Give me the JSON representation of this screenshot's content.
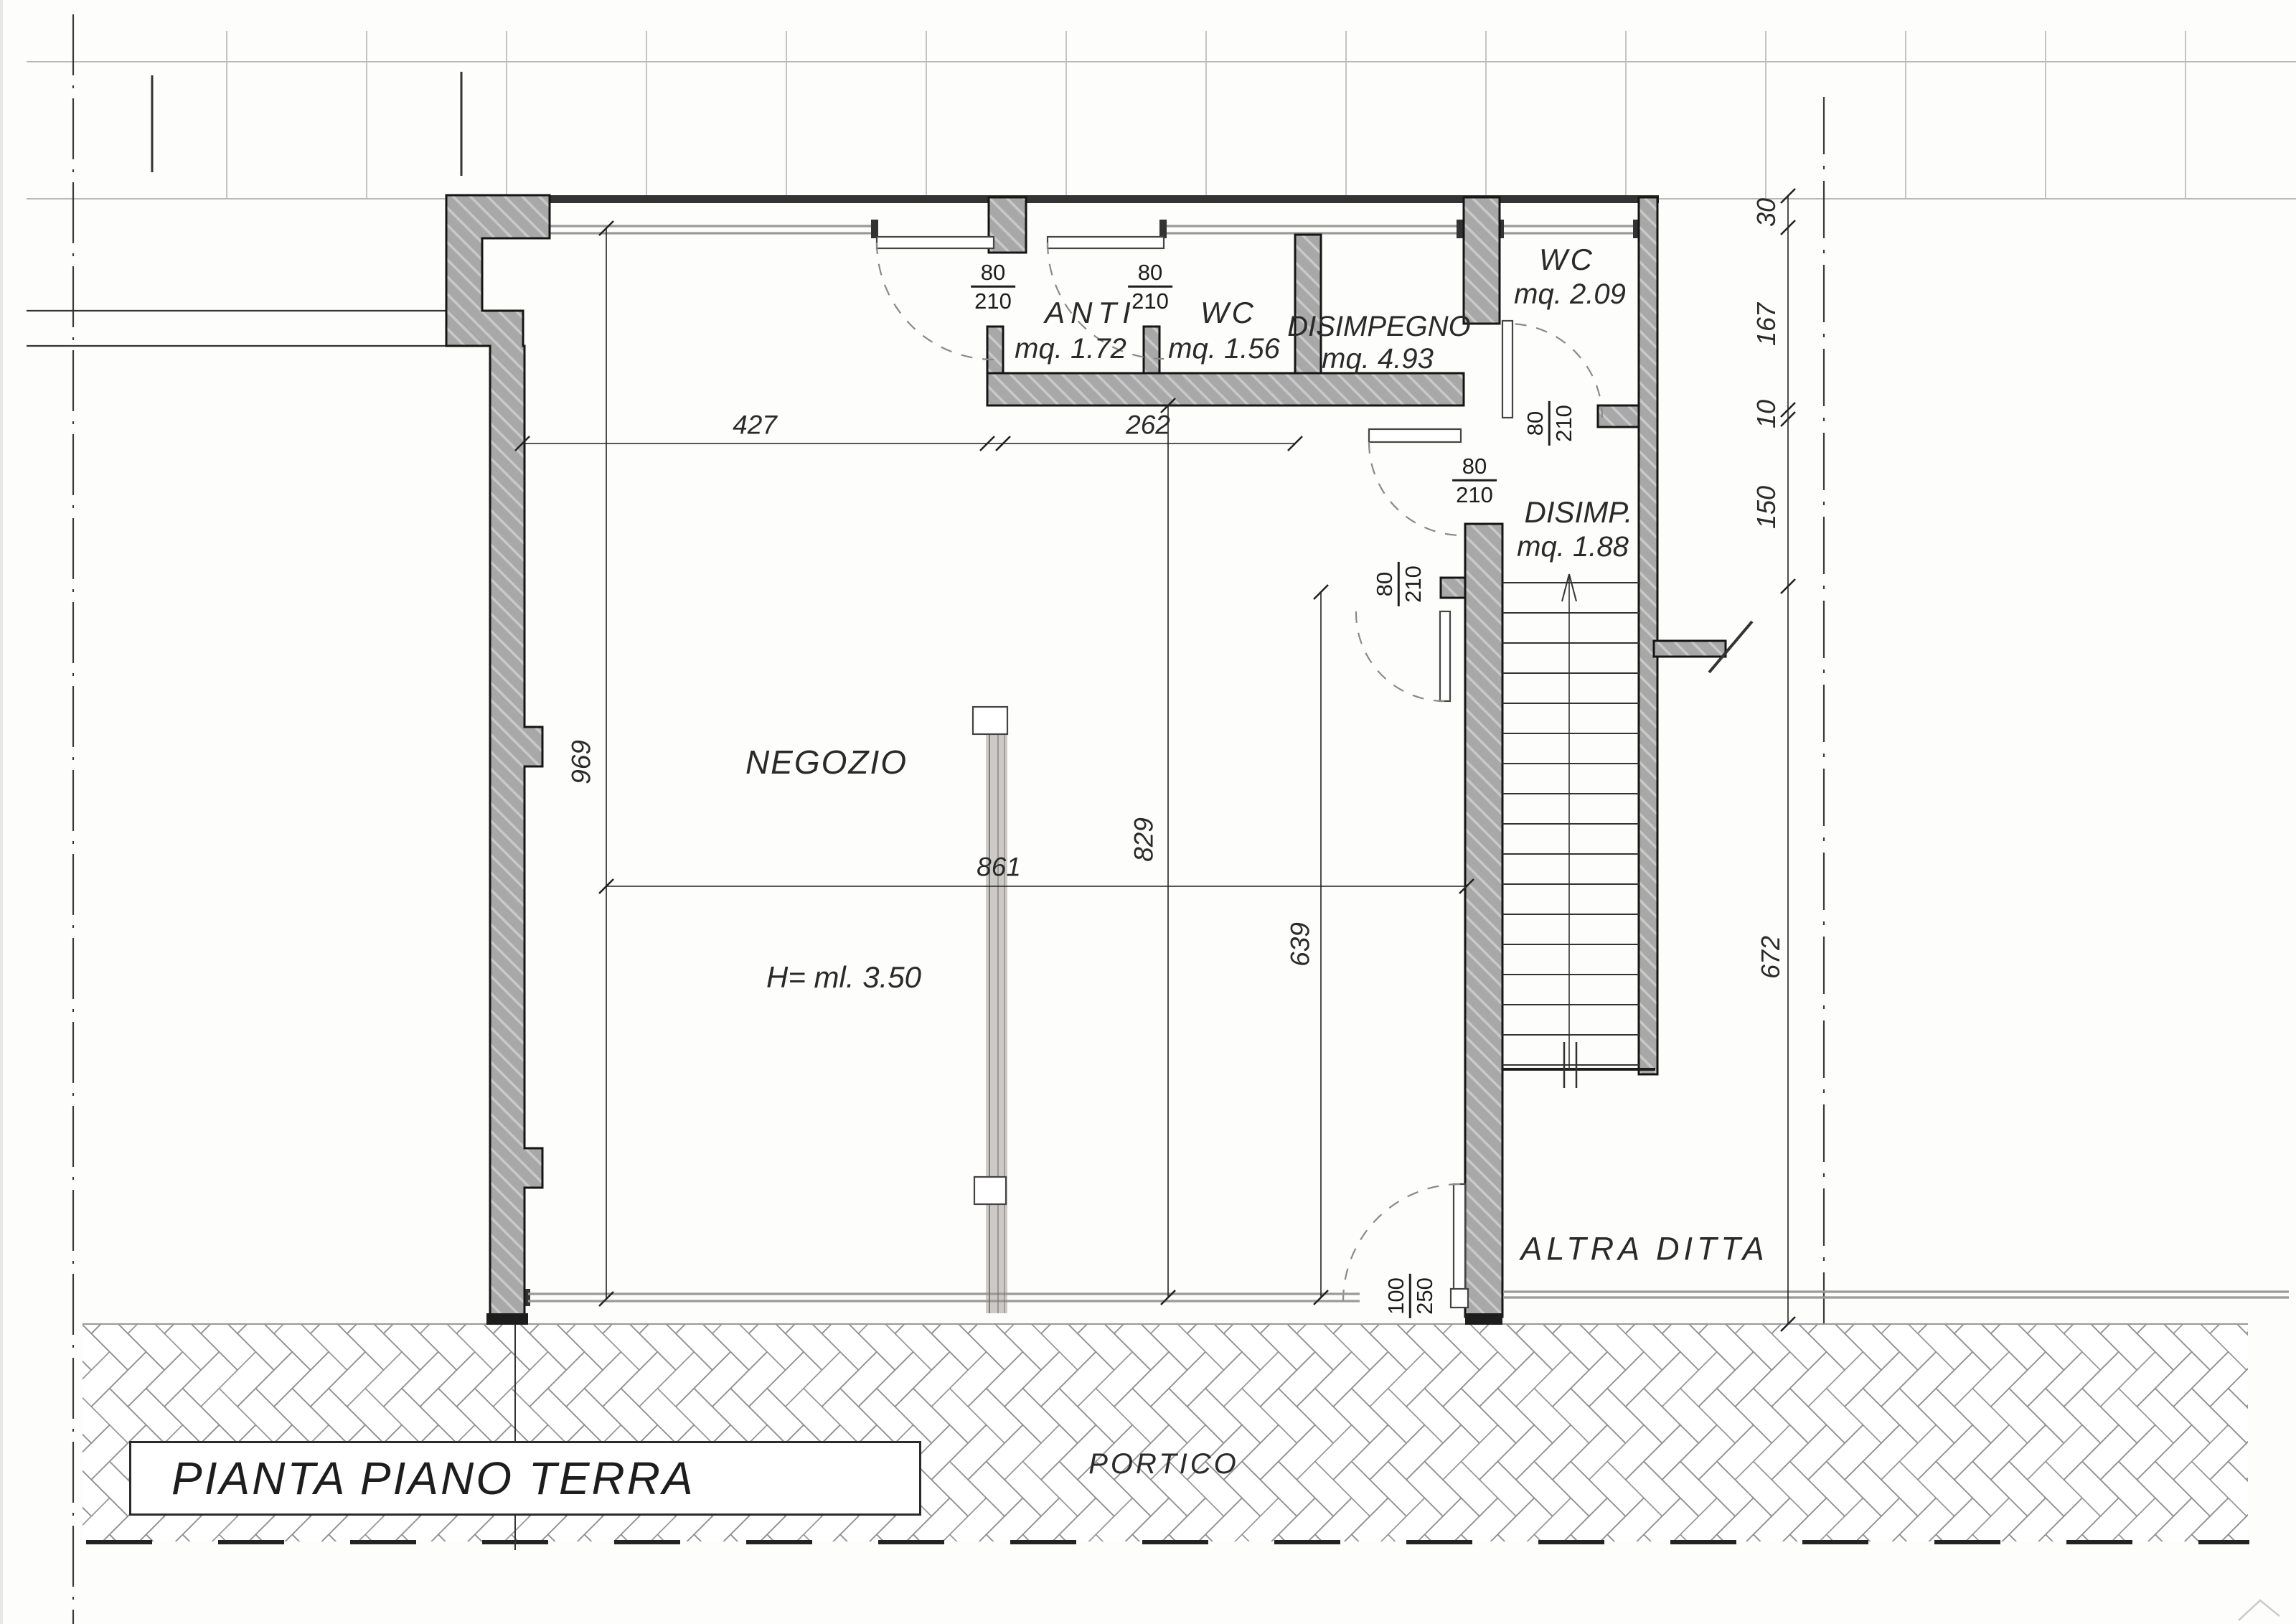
{
  "drawing": {
    "title": "PIANTA PIANO TERRA",
    "rooms": {
      "anti": {
        "name": "ANTI",
        "area": "mq. 1.72"
      },
      "wc_small": {
        "name": "WC",
        "area": "mq. 1.56"
      },
      "disimpegno": {
        "name": "DISIMPEGNO",
        "area": "mq. 4.93"
      },
      "wc_upper": {
        "name": "WC",
        "area": "mq. 2.09"
      },
      "disimp": {
        "name": "DISIMP.",
        "area": "mq. 1.88"
      },
      "negozio": {
        "name": "NEGOZIO",
        "height_note": "H= ml. 3.50"
      },
      "altra_ditta": {
        "name": "ALTRA DITTA"
      },
      "portico": {
        "name": "PORTICO"
      }
    },
    "doors": {
      "anti_entry": {
        "width": "80",
        "height": "210"
      },
      "wc_small_entry": {
        "width": "80",
        "height": "210"
      },
      "wc_upper_entry": {
        "width": "80",
        "height": "210"
      },
      "disimp_passage": {
        "width": "80",
        "height": "210"
      },
      "corridor_door": {
        "width": "80",
        "height": "210"
      },
      "shop_entry": {
        "width": "100",
        "height": "250"
      }
    },
    "dimensions": {
      "w_negozio": "427",
      "w_wc": "262",
      "w_total": "861",
      "h_negozio": "969",
      "h_inner": "829",
      "h_corridor": "639",
      "r_wall": "30",
      "r_wc": "167",
      "r_gap": "10",
      "r_stair": "150",
      "r_lower": "672"
    }
  }
}
